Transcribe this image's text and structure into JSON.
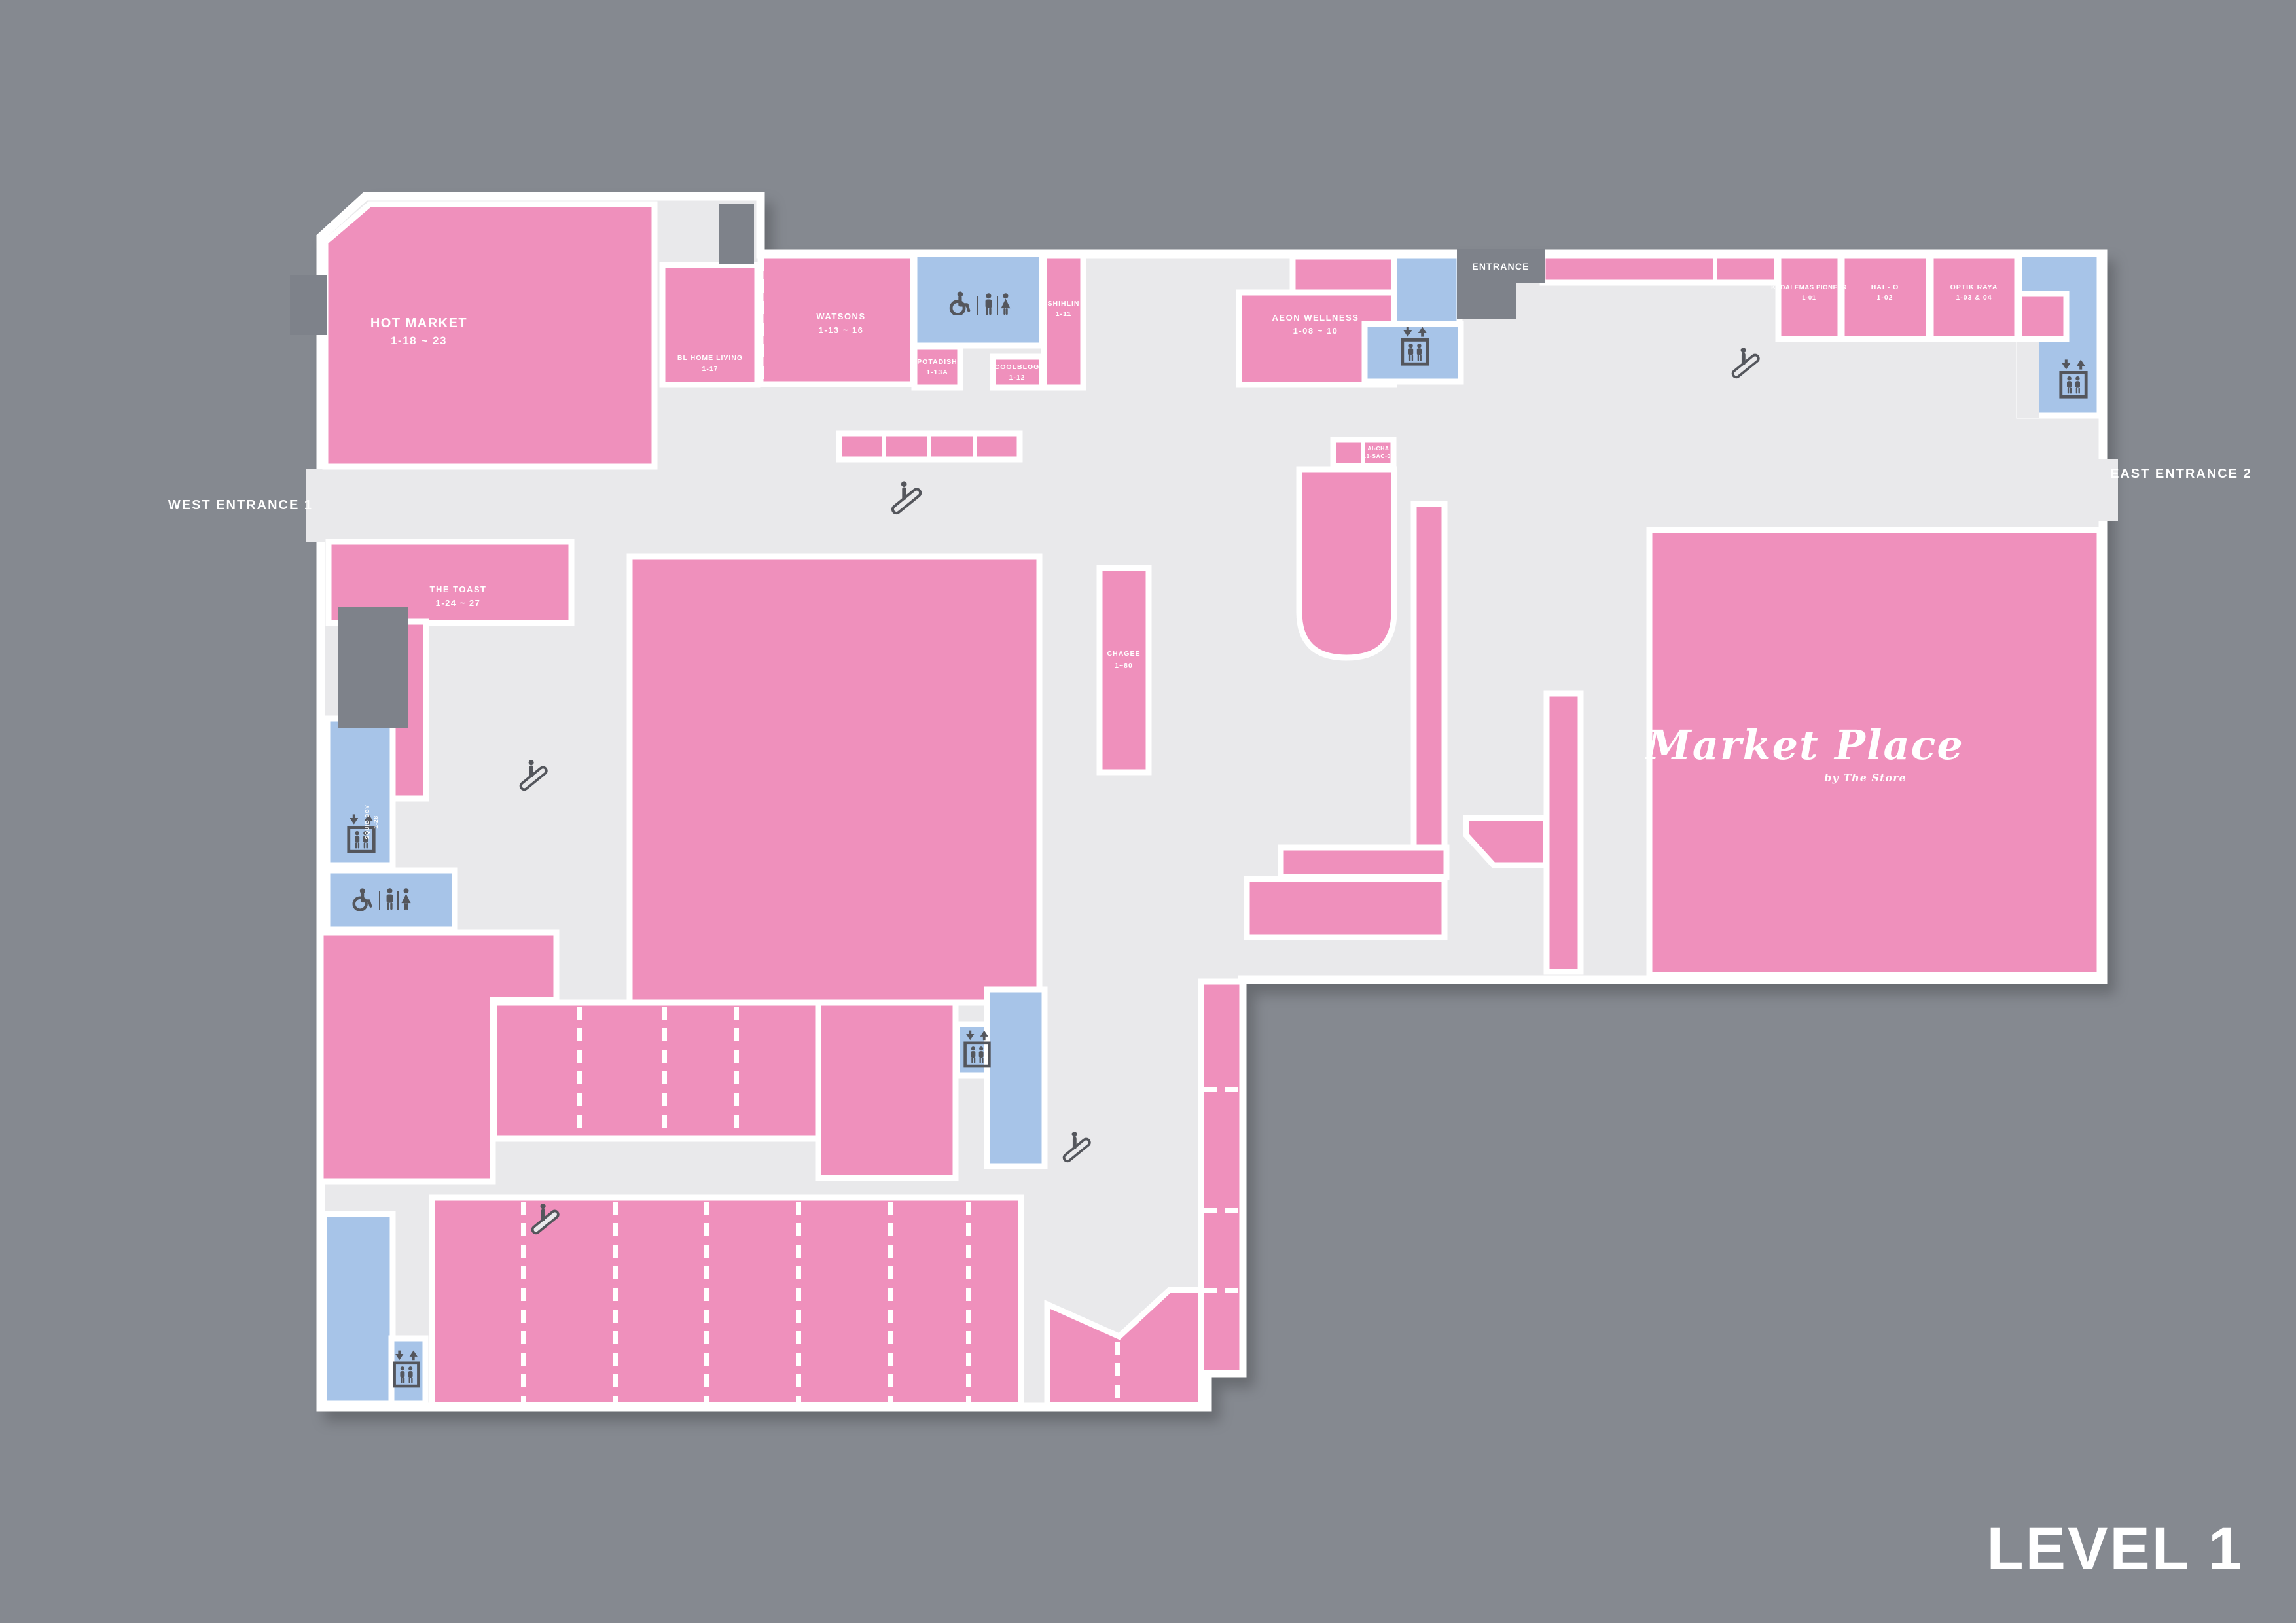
{
  "level_label": "LEVEL 1",
  "entrances": {
    "west": "WEST ENTRANCE 1",
    "east": "EAST ENTRANCE 2",
    "north": "ENTRANCE"
  },
  "logo": {
    "name": "Market Place",
    "byline": "by The Store"
  },
  "stores": {
    "hot_market": {
      "name": "HOT MARKET",
      "unit": "1-18 ~ 23"
    },
    "bl_home_living": {
      "name": "BL HOME LIVING",
      "unit": "1-17"
    },
    "watsons": {
      "name": "WATSONS",
      "unit": "1-13 ~ 16"
    },
    "potadish": {
      "name": "POTADISH",
      "unit": "1-13A"
    },
    "coolblog": {
      "name": "COOLBLOG",
      "unit": "1-12"
    },
    "shihlin": {
      "name": "SHIHLIN",
      "unit": "1-11"
    },
    "aeon_wellness": {
      "name": "AEON WELLNESS",
      "unit": "1-08 ~ 10"
    },
    "kedai_emas_pioneer": {
      "name": "KEDAI EMAS PIONEER",
      "unit": "1-01"
    },
    "hai_o": {
      "name": "HAI - O",
      "unit": "1-02"
    },
    "optik_raya": {
      "name": "OPTIK RAYA",
      "unit": "1-03 & 04"
    },
    "ai_cha": {
      "name": "AI-CHA",
      "unit": "L1-SAC-06"
    },
    "chagee": {
      "name": "CHAGEE",
      "unit": "1~80"
    },
    "the_toast": {
      "name": "THE TOAST",
      "unit": "1-24 ~ 27"
    },
    "squid_boy": {
      "name": "SQUID BOY",
      "unit": "1-28"
    }
  },
  "icons": {
    "escalator": "escalator-icon",
    "elevator": "elevator-icon",
    "wheelchair": "wheelchair-icon",
    "men": "men-restroom-icon",
    "women": "women-restroom-icon"
  },
  "colors": {
    "background": "#858990",
    "floor": "#E9E9EB",
    "store_pink": "#EF90BC",
    "facility_blue": "#A7C4E8",
    "void_gray": "#7E828A",
    "icon_gray": "#54565C",
    "label": "#FFFFFF"
  }
}
